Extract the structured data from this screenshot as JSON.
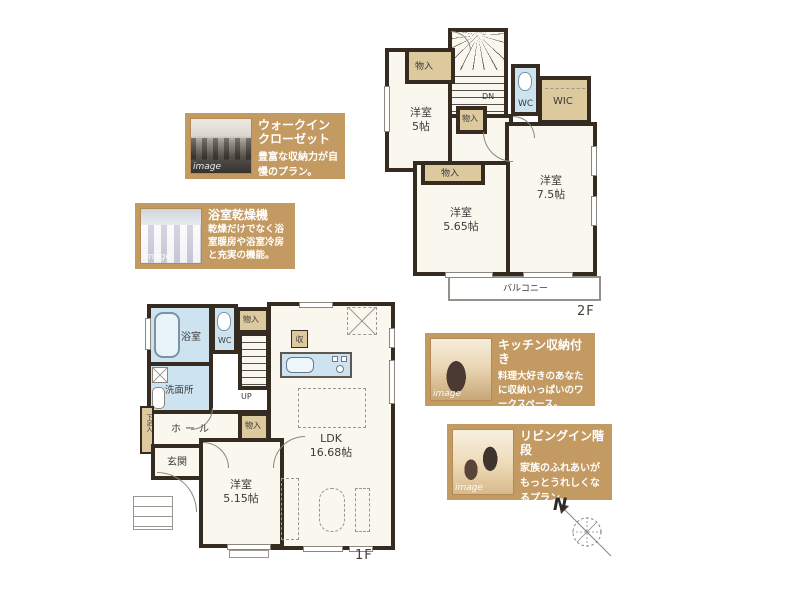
{
  "colors": {
    "wall": "#352b20",
    "room_fill": "#faf8ee",
    "closet_fill": "#dcc99d",
    "wet_area_fill": "#cde4f0",
    "annotation_background": "#c49a63",
    "annotation_text": "#ffffff"
  },
  "plan2f": {
    "floor_label": "2F",
    "stairs_label": "DN",
    "wc_label": "WC",
    "wic_label": "WIC",
    "balcony_label": "バルコニー",
    "closets": [
      "物入",
      "物入",
      "物入"
    ],
    "rooms": {
      "yoshitsu5": {
        "name": "洋室",
        "size": "5帖"
      },
      "yoshitsu565": {
        "name": "洋室",
        "size": "5.65帖"
      },
      "yoshitsu75": {
        "name": "洋室",
        "size": "7.5帖"
      }
    }
  },
  "plan1f": {
    "floor_label": "1F",
    "stairs_label": "UP",
    "bathroom_label": "浴室",
    "wc_label": "WC",
    "washroom_label": "洗面所",
    "hall_label": "ホール",
    "entrance_label": "玄関",
    "shoe_cabinet_label": "下足入",
    "storage_chip_label": "収",
    "closets": [
      "物入",
      "物入"
    ],
    "rooms": {
      "ldk": {
        "name": "LDK",
        "size": "16.68帖"
      },
      "yoshitsu515": {
        "name": "洋室",
        "size": "5.15帖"
      }
    }
  },
  "annotations": [
    {
      "title": "ウォークイン\nクローゼット",
      "body": "豊富な収納力が自慢のプラン。",
      "watermark": "image"
    },
    {
      "title": "浴室乾燥機",
      "body": "乾燥だけでなく浴室暖房や浴室冷房と充実の機能。",
      "watermark": "image"
    },
    {
      "title": "キッチン収納付き",
      "body": "料理大好きのあなたに収納いっぱいのワークスペース。",
      "watermark": "image"
    },
    {
      "title": "リビングイン階段",
      "body": "家族のふれあいがもっとうれしくなるプラン。",
      "watermark": "image"
    }
  ],
  "compass": {
    "north_label": "N"
  }
}
